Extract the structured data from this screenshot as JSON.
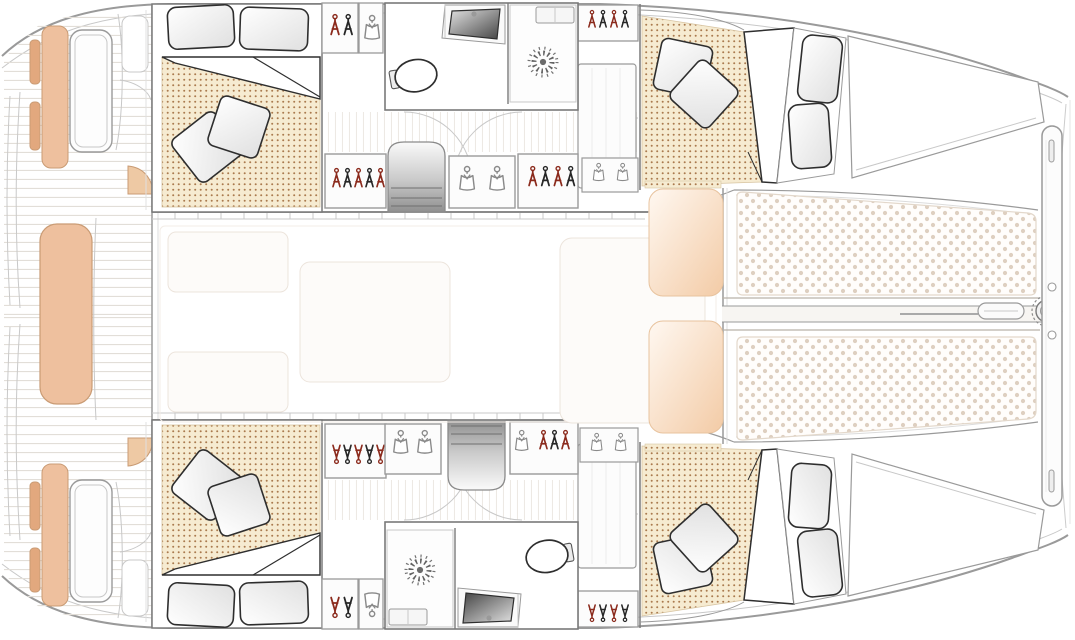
{
  "diagram": {
    "title": "Catamaran yacht accommodation floor plan, bow to the right",
    "type": "floor-plan",
    "orientation": "bow-right",
    "symmetry": "port and starboard hulls mirrored about centerline",
    "areas": {
      "aft_cockpit": {
        "label": "Aft cockpit",
        "features": [
          "aft bench seat",
          "side bench with cushions",
          "cockpit table",
          "helm console",
          "transom steps",
          "teak deck planking",
          "companionway steps"
        ]
      },
      "saloon": {
        "label": "Saloon / bridgedeck",
        "features": [
          "galley units",
          "dinette table",
          "settee",
          "forward-facing seats"
        ]
      },
      "port_hull": {
        "label": "Port hull (top)",
        "rooms": [
          "aft double cabin",
          "bathroom with shower, toilet and basin",
          "corridor with wardrobes",
          "forward double cabin"
        ],
        "storage": [
          "hanger wardrobes",
          "shirt lockers",
          "tall hanging locker",
          "companionway stairs"
        ]
      },
      "starboard_hull": {
        "label": "Starboard hull (bottom)",
        "rooms": [
          "aft double cabin",
          "bathroom with shower, toilet and basin",
          "corridor with wardrobes",
          "forward double cabin"
        ],
        "storage": [
          "hanger wardrobes",
          "shirt lockers",
          "tall hanging locker",
          "companionway stairs"
        ]
      },
      "foredeck": {
        "label": "Foredeck",
        "features": [
          "twin trampolines",
          "central walkway beam",
          "bowsprit",
          "anchor/furler fitting",
          "forward crossbeam",
          "bridle lines"
        ]
      }
    },
    "fixtures": {
      "double_beds": 4,
      "pillows_per_bed": 4,
      "bathrooms": 2,
      "showers": 2,
      "toilets": 2,
      "basins": 2,
      "staircases": 2,
      "trampolines": 2,
      "cockpit_tables": 2
    },
    "colors": {
      "bench": "#eec09e",
      "bench-dark": "#e2a87e",
      "bench-edge": "#c99b74",
      "mattress": "#f6ebd1",
      "mattress-dot": "#aa7a4e",
      "tramp-base": "#fffdfb",
      "tramp-dot": "#decfc0",
      "peach": "#f3cba6",
      "hanger-red": "#8b2a1c",
      "ink": "#2e2e2e",
      "wall": "#7a7a7a",
      "line": "#9a9a9a",
      "line-light": "#c8c8c8",
      "plank": "#e2ded8",
      "stair-dark": "#8f8f8f"
    }
  }
}
